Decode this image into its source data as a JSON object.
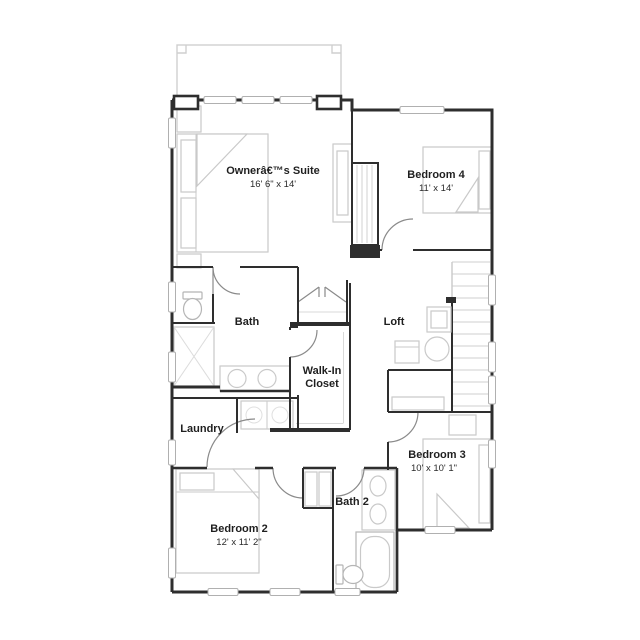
{
  "floor_plan": {
    "rooms": {
      "owners_suite": {
        "name": "Ownerâ€™s Suite",
        "dims": "16' 6\" x 14'"
      },
      "bedroom4": {
        "name": "Bedroom 4",
        "dims": "11' x 14'"
      },
      "bath": {
        "name": "Bath"
      },
      "loft": {
        "name": "Loft"
      },
      "walk_in_closet": {
        "line1": "Walk-In",
        "line2": "Closet"
      },
      "laundry": {
        "name": "Laundry"
      },
      "bedroom3": {
        "name": "Bedroom 3",
        "dims": "10' x 10' 1\""
      },
      "bedroom2": {
        "name": "Bedroom 2",
        "dims": "12' x 11' 2\""
      },
      "bath2": {
        "name": "Bath 2"
      }
    },
    "colors": {
      "wall": "#2e2e2e",
      "furniture": "#c9c9c9",
      "door_swing": "#8a8a8a",
      "text": "#1f1f1f"
    }
  }
}
